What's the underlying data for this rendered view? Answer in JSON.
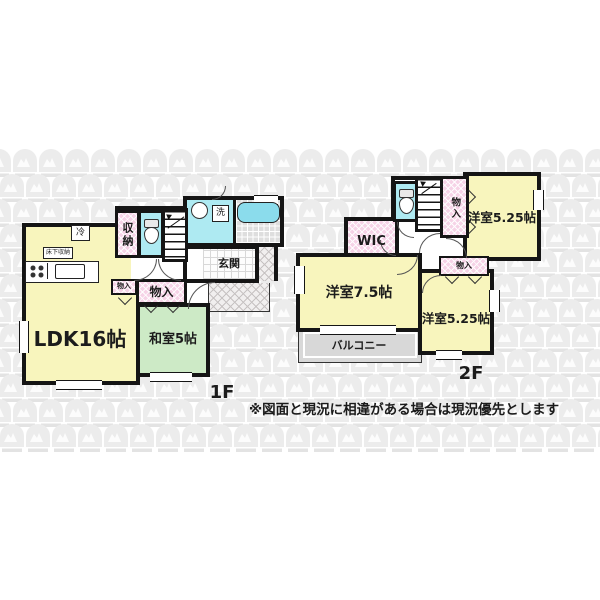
{
  "floorplan": {
    "floor1": {
      "label": "1F",
      "ldk": "LDK16帖",
      "washitsu": "和室5帖",
      "shuno": "収納",
      "genkan": "玄関",
      "sen": "洗",
      "rei": "冷",
      "yukashita": "床下収納",
      "monoire_small": "物入",
      "monoire_hall": "物入"
    },
    "floor2": {
      "label": "2F",
      "yoshitsu525_top": "洋室5.25帖",
      "yoshitsu75": "洋室7.5帖",
      "yoshitsu525_btm": "洋室5.25帖",
      "wic": "WIC",
      "monoire_vert": "物入",
      "monoire_btm": "物入",
      "balcony": "バルコニー"
    },
    "note": "※図面と現況に相違がある場合は現況優先とします"
  },
  "colors": {
    "wall": "#151515",
    "room_yellow": "#f8f5bd",
    "room_green": "#cdeac6",
    "room_cyan": "#aeeaf2",
    "closet_pink": "#f6d3e7",
    "balcony_gray": "#d8d8d8",
    "tub_cyan": "#8bdcec",
    "pattern_gray": "#ececec",
    "pattern_text": "#e3e3e3"
  }
}
